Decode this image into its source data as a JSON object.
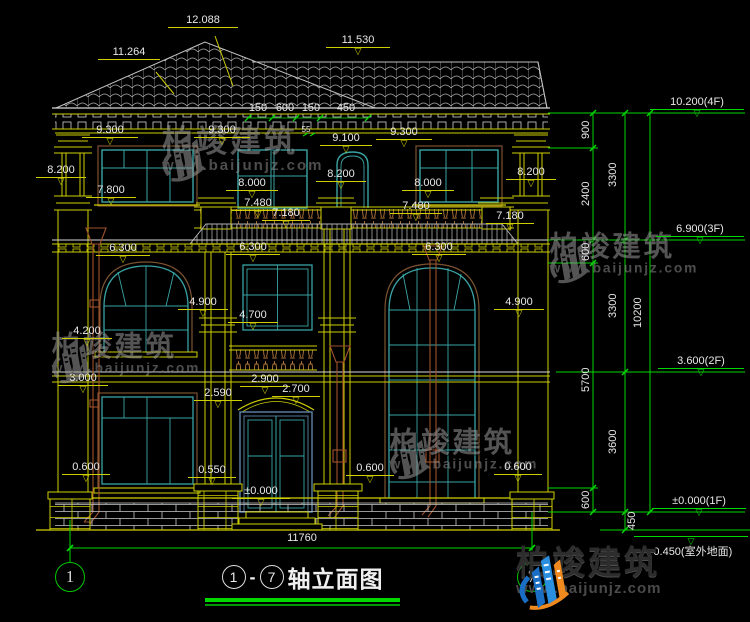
{
  "drawing_title": {
    "axis_start": "1",
    "axis_end": "7",
    "separator": "-",
    "name": "轴立面图"
  },
  "axis_bubbles": {
    "left": "1",
    "right": "7"
  },
  "branding": {
    "name": "柏竣建筑",
    "url": "www.baijunjz.com"
  },
  "overall_width_dim": "11760",
  "roof_dims": {
    "peak": "12.088",
    "left_ridge": "11.264",
    "right_ridge": "11.530"
  },
  "top_small_dims": [
    "150",
    "600",
    "150",
    "450"
  ],
  "slope_note": "55",
  "annotations": {
    "facade": [
      {
        "text": "12.088",
        "x": 168,
        "y": 14,
        "lw": 70,
        "tri": false
      },
      {
        "text": "11.264",
        "x": 98,
        "y": 46,
        "lw": 62,
        "tri": false
      },
      {
        "text": "11.530",
        "x": 326,
        "y": 34,
        "lw": 64,
        "tri": true
      },
      {
        "text": "9.300",
        "x": 82,
        "y": 124,
        "lw": 56,
        "tri": true
      },
      {
        "text": "9.300",
        "x": 194,
        "y": 124,
        "lw": 56,
        "tri": true
      },
      {
        "text": "9.100",
        "x": 320,
        "y": 132,
        "lw": 52,
        "tri": true
      },
      {
        "text": "9.300",
        "x": 376,
        "y": 126,
        "lw": 56,
        "tri": true
      },
      {
        "text": "8.200",
        "x": 36,
        "y": 164,
        "lw": 50,
        "tri": true
      },
      {
        "text": "7.800",
        "x": 86,
        "y": 184,
        "lw": 50,
        "tri": true
      },
      {
        "text": "8.000",
        "x": 226,
        "y": 177,
        "lw": 52,
        "tri": true
      },
      {
        "text": "8.200",
        "x": 316,
        "y": 168,
        "lw": 50,
        "tri": true
      },
      {
        "text": "8.000",
        "x": 402,
        "y": 177,
        "lw": 52,
        "tri": true
      },
      {
        "text": "8.200",
        "x": 506,
        "y": 166,
        "lw": 50,
        "tri": true
      },
      {
        "text": "7.480",
        "x": 232,
        "y": 197,
        "lw": 52,
        "tri": true
      },
      {
        "text": "7.180",
        "x": 262,
        "y": 207,
        "lw": 48,
        "tri": true
      },
      {
        "text": "7.480",
        "x": 390,
        "y": 200,
        "lw": 52,
        "tri": true
      },
      {
        "text": "7.180",
        "x": 486,
        "y": 210,
        "lw": 48,
        "tri": true
      },
      {
        "text": "6.300",
        "x": 96,
        "y": 242,
        "lw": 54,
        "tri": true
      },
      {
        "text": "6.300",
        "x": 226,
        "y": 241,
        "lw": 54,
        "tri": true
      },
      {
        "text": "6.300",
        "x": 412,
        "y": 241,
        "lw": 54,
        "tri": true
      },
      {
        "text": "4.900",
        "x": 178,
        "y": 296,
        "lw": 50,
        "tri": true
      },
      {
        "text": "4.700",
        "x": 228,
        "y": 309,
        "lw": 50,
        "tri": true
      },
      {
        "text": "4.900",
        "x": 494,
        "y": 296,
        "lw": 50,
        "tri": true
      },
      {
        "text": "4.200",
        "x": 62,
        "y": 325,
        "lw": 50,
        "tri": true
      },
      {
        "text": "3.000",
        "x": 58,
        "y": 372,
        "lw": 50,
        "tri": true
      },
      {
        "text": "2.590",
        "x": 194,
        "y": 387,
        "lw": 48,
        "tri": true
      },
      {
        "text": "2.900",
        "x": 240,
        "y": 373,
        "lw": 50,
        "tri": true
      },
      {
        "text": "2.700",
        "x": 272,
        "y": 383,
        "lw": 48,
        "tri": true
      },
      {
        "text": "0.600",
        "x": 62,
        "y": 461,
        "lw": 48,
        "tri": true
      },
      {
        "text": "0.550",
        "x": 188,
        "y": 464,
        "lw": 48,
        "tri": true
      },
      {
        "text": "±0.000",
        "x": 232,
        "y": 485,
        "lw": 58,
        "tri": true
      },
      {
        "text": "0.600",
        "x": 346,
        "y": 462,
        "lw": 48,
        "tri": true
      },
      {
        "text": "0.600",
        "x": 494,
        "y": 461,
        "lw": 48,
        "tri": true
      }
    ],
    "plain": [
      {
        "text": "150",
        "x": 246,
        "y": 102,
        "lw": 24
      },
      {
        "text": "600",
        "x": 272,
        "y": 102,
        "lw": 26
      },
      {
        "text": "150",
        "x": 299,
        "y": 102,
        "lw": 24
      },
      {
        "text": "450",
        "x": 332,
        "y": 102,
        "lw": 28
      },
      {
        "text": "11760",
        "x": 272,
        "y": 532,
        "lw": 60
      }
    ],
    "slope": [
      {
        "text": "55",
        "x": 299,
        "y": 126,
        "lw": 14
      }
    ],
    "levels": [
      {
        "text": "10.200(4F)",
        "x": 650,
        "y": 96,
        "lw": 94
      },
      {
        "text": "6.900(3F)",
        "x": 656,
        "y": 223,
        "lw": 88
      },
      {
        "text": "3.600(2F)",
        "x": 658,
        "y": 355,
        "lw": 86
      },
      {
        "text": "±0.000(1F)",
        "x": 652,
        "y": 495,
        "lw": 94
      }
    ],
    "ground_level": {
      "text": "-0.450(室外地面)",
      "x": 634,
      "y": 536,
      "lw": 114
    },
    "chains": [
      {
        "text": "900",
        "x": 580,
        "y": 141
      },
      {
        "text": "2400",
        "x": 580,
        "y": 208
      },
      {
        "text": "600",
        "x": 580,
        "y": 263
      },
      {
        "text": "5700",
        "x": 580,
        "y": 394
      },
      {
        "text": "600",
        "x": 580,
        "y": 511
      },
      {
        "text": "3300",
        "x": 607,
        "y": 189
      },
      {
        "text": "3300",
        "x": 607,
        "y": 320
      },
      {
        "text": "3600",
        "x": 607,
        "y": 456
      },
      {
        "text": "450",
        "x": 626,
        "y": 532
      },
      {
        "text": "10200",
        "x": 632,
        "y": 330
      }
    ]
  },
  "watermarks": [
    {
      "x": 158,
      "y": 126,
      "scale": 1.0
    },
    {
      "x": 546,
      "y": 232,
      "scale": 0.92
    },
    {
      "x": 48,
      "y": 332,
      "scale": 0.92
    },
    {
      "x": 386,
      "y": 428,
      "scale": 0.92
    }
  ],
  "colors": {
    "line_yellow": "#cfcf00",
    "line_green": "#00d800",
    "frame_teal": "#39a3a3",
    "pipe_brown": "#a0522d",
    "text_white": "#e8e8e8",
    "logo_blue": "#1a6fc4",
    "logo_orange": "#f08a1e"
  }
}
